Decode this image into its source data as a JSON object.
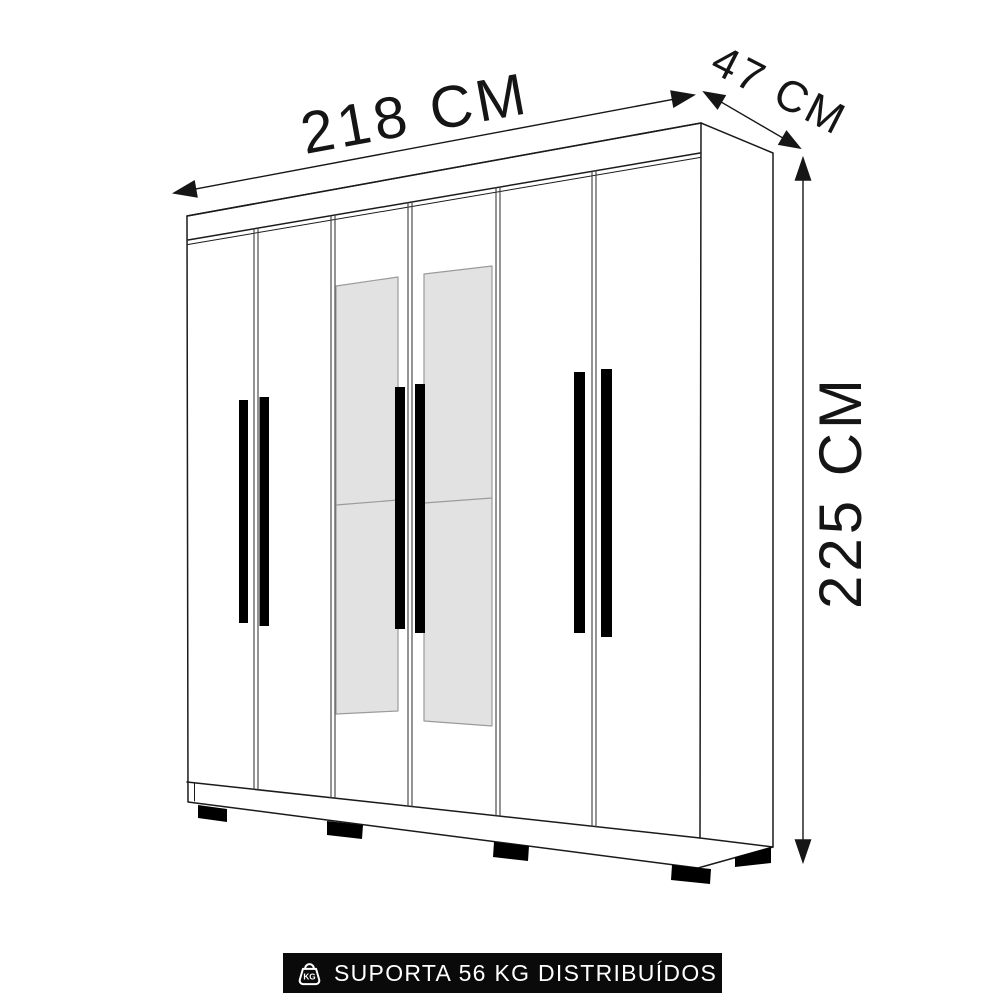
{
  "dimensions": {
    "width": "218 CM",
    "depth": "47 CM",
    "height": "225 CM"
  },
  "wardrobe": {
    "door_count": 6,
    "mirrored_door_count": 2,
    "handle_count": 6,
    "front_feet_count": 4,
    "side_feet_count": 1,
    "colors": {
      "line": "#1a1a1a",
      "handle": "#000000",
      "mirror_fill": "#e2e2e2",
      "mirror_edge": "#9b9b9b",
      "body_fill": "#ffffff"
    }
  },
  "footer": {
    "support_text": "SUPORTA 56 KG DISTRIBUÍDOS",
    "weight_icon_label": "KG",
    "bg_color": "#0a0a0a",
    "text_color": "#ffffff"
  }
}
